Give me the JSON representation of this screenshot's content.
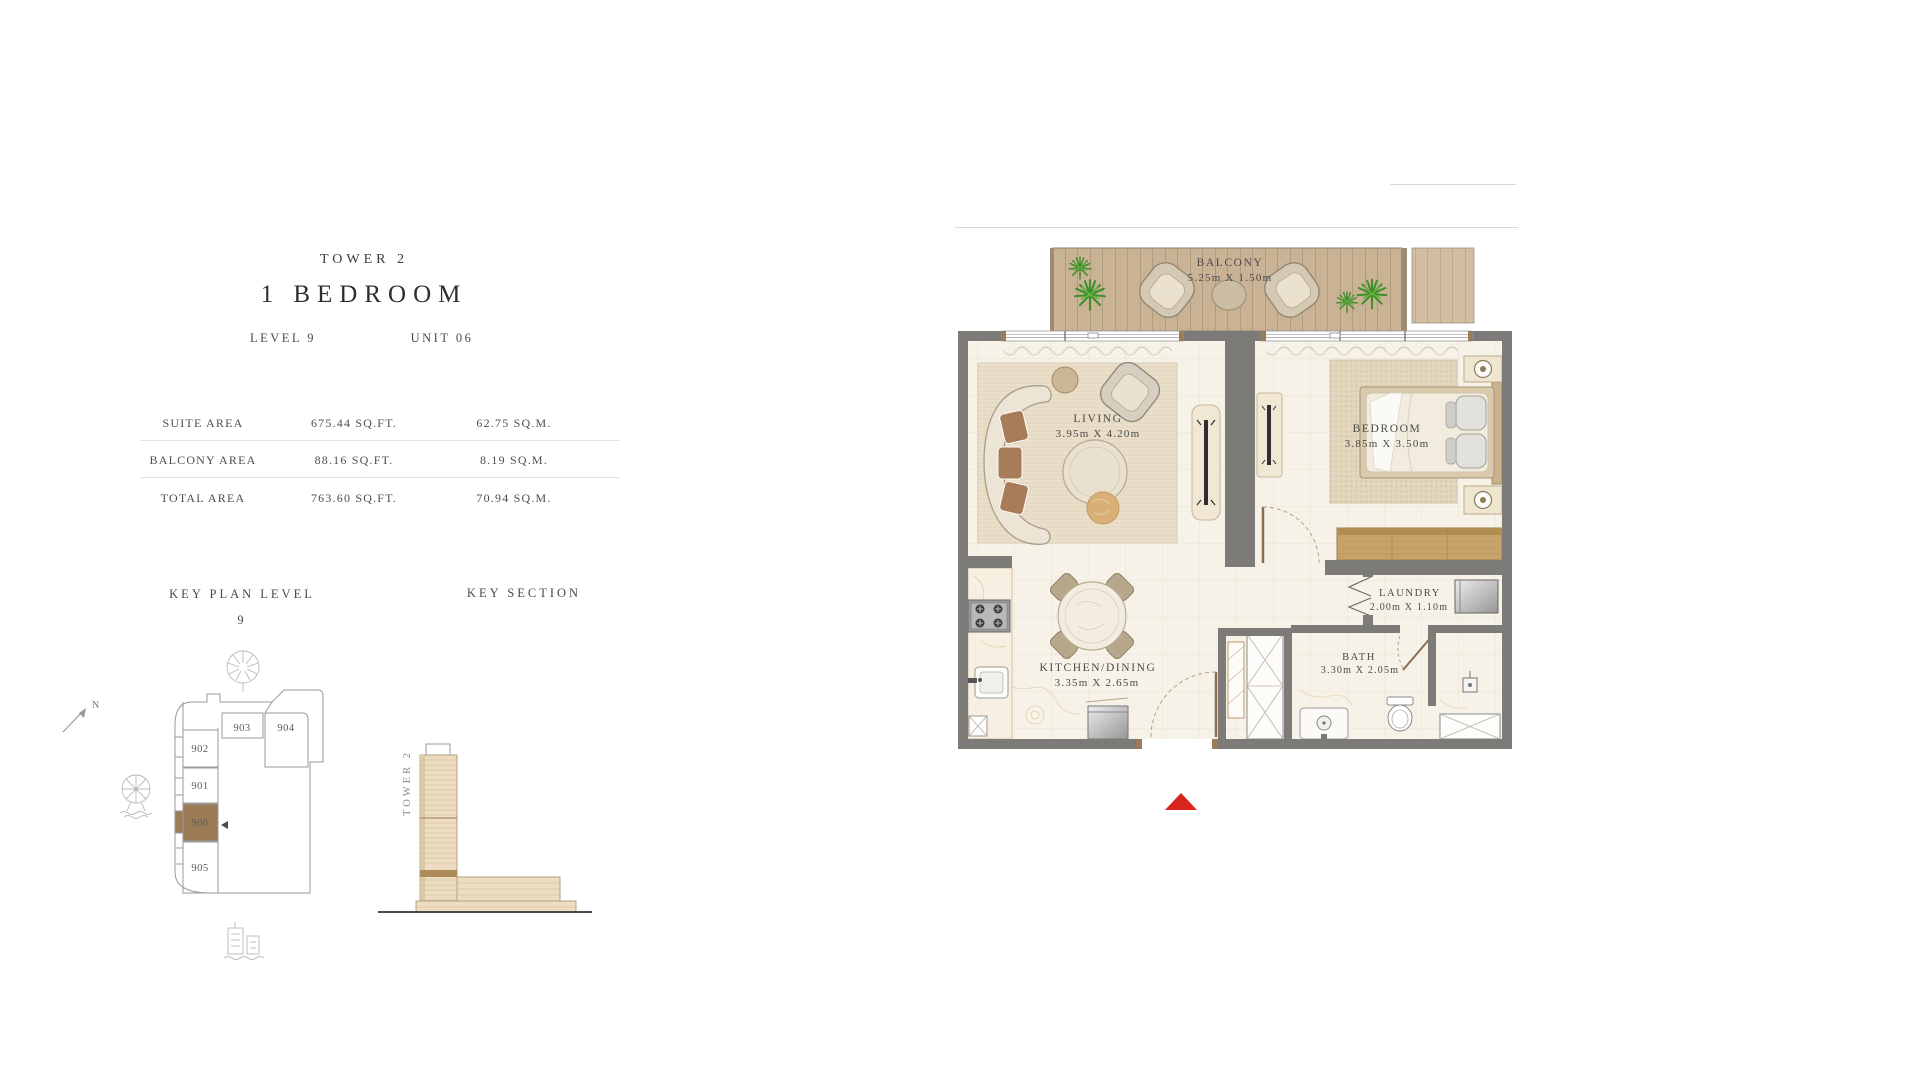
{
  "title_block": {
    "tower": "TOWER 2",
    "unit_type": "1 BEDROOM",
    "level": "LEVEL 9",
    "unit": "UNIT 06"
  },
  "area_table": {
    "rows": [
      {
        "label": "SUITE AREA",
        "sqft": "675.44 SQ.FT.",
        "sqm": "62.75 SQ.M."
      },
      {
        "label": "BALCONY AREA",
        "sqft": "88.16 SQ.FT.",
        "sqm": "8.19 SQ.M."
      },
      {
        "label": "TOTAL AREA",
        "sqft": "763.60 SQ.FT.",
        "sqm": "70.94 SQ.M."
      }
    ]
  },
  "key_plan": {
    "heading": "KEY PLAN LEVEL",
    "level_number": "9",
    "north_label": "N",
    "units": [
      "902",
      "903",
      "904",
      "901",
      "906",
      "905"
    ],
    "highlighted_unit": "906",
    "highlight_color": "#9b7c57"
  },
  "key_section": {
    "heading": "KEY SECTION",
    "tower_label": "TOWER 2"
  },
  "floor_plan": {
    "rooms": [
      {
        "name": "BALCONY",
        "dims": "5.25m X 1.50m"
      },
      {
        "name": "LIVING",
        "dims": "3.95m X 4.20m"
      },
      {
        "name": "BEDROOM",
        "dims": "3.85m X 3.50m"
      },
      {
        "name": "KITCHEN/DINING",
        "dims": "3.35m X 2.65m"
      },
      {
        "name": "LAUNDRY",
        "dims": "2.00m X 1.10m"
      },
      {
        "name": "BATH",
        "dims": "3.30m X 2.05m"
      }
    ],
    "wall_color": "#7d7b77",
    "floor_color": "#f7f2e8",
    "deck_color": "#c9b394",
    "entry_marker_color": "#d7251d"
  }
}
